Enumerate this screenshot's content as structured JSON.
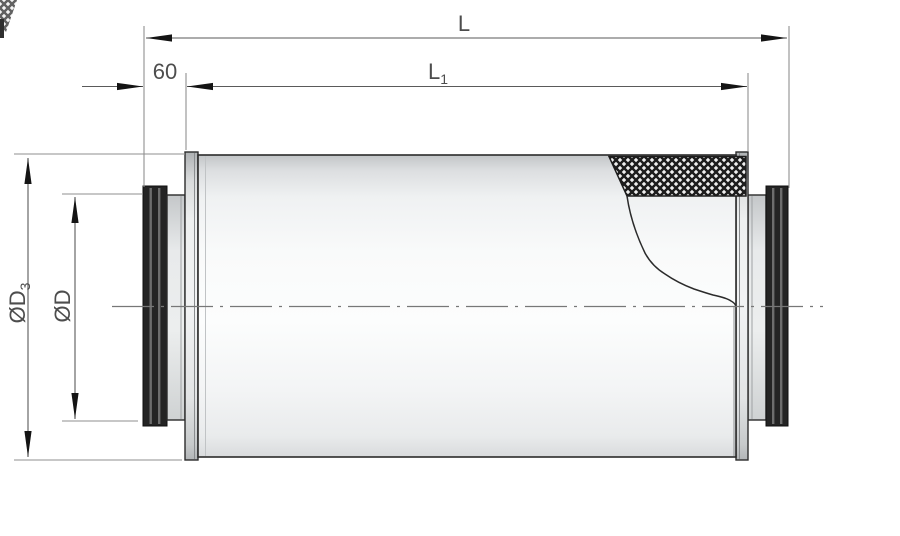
{
  "figure": {
    "labels": {
      "overall_length": "L",
      "casing_length_main": "L",
      "casing_length_sub": "1",
      "spigot_length": "60",
      "outer_diameter_main": "ØD",
      "outer_diameter_sub": "3",
      "duct_diameter_main": "ØD"
    },
    "colors": {
      "background": "#ffffff",
      "part_edge": "#2b2b2b",
      "dimension_line": "#5a5a5a",
      "extension_line": "#8f8f8f",
      "centerline": "#777777",
      "label_text": "#4d4d4d",
      "insulation_hatch": "#1d1d1d",
      "body_highlight": "#fbfcfc",
      "body_shadow": "#c2c5c7",
      "spigot_ring_dark": "#242424"
    }
  }
}
